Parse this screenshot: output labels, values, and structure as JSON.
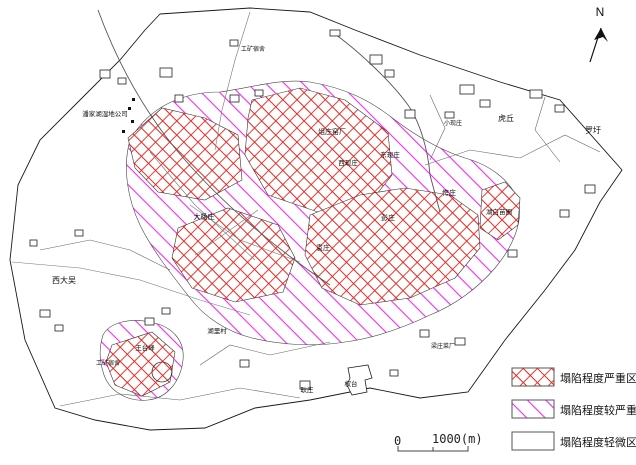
{
  "map": {
    "north_label": "N",
    "labels": {
      "panjiahu": "潘家湖湿地公司",
      "gongkuang_top": "工矿宿舍",
      "yaochang": "俎庄窑厂",
      "xixianzhuang": "西现庄",
      "dongxianzhuang": "东现庄",
      "xiaoxianzhuang": "小现庄",
      "huqiu": "虎丘",
      "luowei": "罗圩",
      "kuazhuang": "侉庄",
      "miaopu": "湖白苗圃",
      "pengzhuang": "彭庄",
      "dayangzhuang": "大杨庄",
      "yuanzhuang": "袁庄",
      "xidawu": "西大吴",
      "hulicun": "湖里村",
      "wangtaifeng": "王台峰",
      "gongkuang_bottom": "工矿宿舍",
      "gengzhuang": "耿庄",
      "quantai": "权台",
      "caichang": "梁庄菜厂"
    }
  },
  "legend": {
    "items": [
      {
        "label": "塌陷程度严重区",
        "pattern": "red-crosshatch"
      },
      {
        "label": "塌陷程度较严重区",
        "pattern": "magenta-diagonal"
      },
      {
        "label": "塌陷程度轻微区",
        "pattern": "none"
      }
    ]
  },
  "scale_bar": {
    "zero_label": "0",
    "max_label": "1000(m)"
  },
  "colors": {
    "severe_hatch": "#e8251f",
    "less_severe_hatch": "#f32df3",
    "map_outline": "#1a1a1a"
  }
}
